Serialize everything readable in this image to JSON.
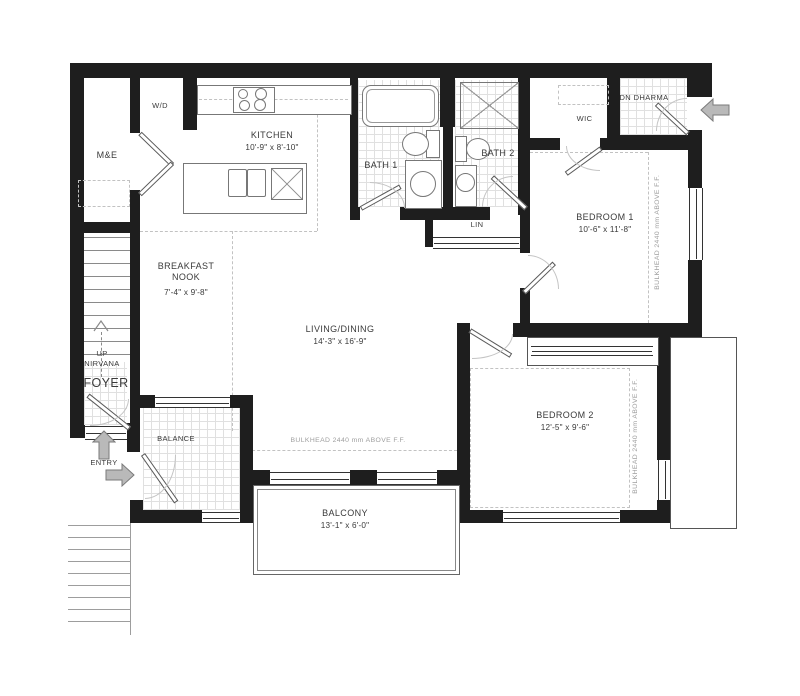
{
  "title": "2 bedroom unit floor plan",
  "rooms": {
    "kitchen": {
      "name": "KITCHEN",
      "dims": "10'-9\" x 8'-10\""
    },
    "nook": {
      "name": "BREAKFAST NOOK",
      "dims": "7'-4\" x 9'-8\""
    },
    "living": {
      "name": "LIVING/DINING",
      "dims": "14'-3\" x 16'-9\""
    },
    "bedroom1": {
      "name": "BEDROOM 1",
      "dims": "10'-6\" x 11'-8\""
    },
    "bedroom2": {
      "name": "BEDROOM 2",
      "dims": "12'-5\" x 9'-6\""
    },
    "bath1": {
      "name": "BATH 1"
    },
    "bath2": {
      "name": "BATH 2"
    },
    "balcony": {
      "name": "BALCONY",
      "dims": "13'-1\" x 6'-0\""
    },
    "foyer": {
      "name": "FOYER"
    },
    "me": {
      "name": "M&E"
    },
    "wd": {
      "name": "W/D"
    },
    "wic": {
      "name": "WIC"
    },
    "lin": {
      "name": "LIN"
    },
    "balance": {
      "name": "BALANCE"
    }
  },
  "annotations": {
    "bulkhead": "BULKHEAD 2440 mm ABOVE F.F.",
    "stair_up_dir": "UP",
    "stair_up_name": "NIRVANA",
    "stair_dn": "DN DHARMA",
    "entry": "ENTRY"
  },
  "colors": {
    "wall": "#1e1e1e",
    "arrow_fill": "#b9b9b9",
    "arrow_stroke": "#7a7a7a",
    "tile_line": "#e0e0e0",
    "bulkhead_text": "#9e9e9e"
  }
}
